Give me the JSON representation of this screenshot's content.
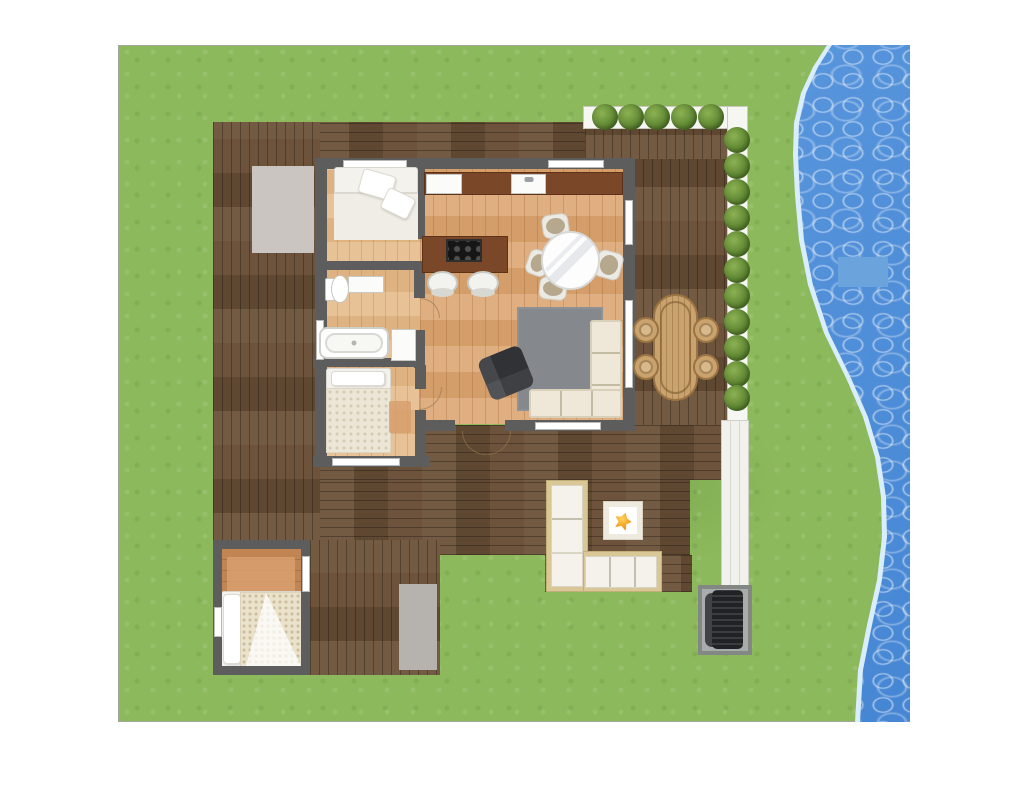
{
  "palette": {
    "grass_base": "#8cb95b",
    "water_main": "#4f93e0",
    "water_light": "#d9edfc",
    "water_patch": "#6ba3dc",
    "deck_dark": "#6a5037",
    "wood_floor": "#dca673",
    "wood_floor_light": "#e6bb8b",
    "cabin_floor": "#c08553",
    "wall": "#5d5d5d",
    "counter": "#7b4729",
    "cream": "#efe8d8",
    "rug_gray": "#85898d",
    "mat_gray": "#b6b2ad",
    "mat_warm": "#cac5c0",
    "rattan": "#c9a26e",
    "rattan_dark": "#9a7442",
    "tan_rug": "#d89f6e"
  },
  "scene": {
    "description": "top-down floor plan of a small house with wrap deck, top-right hedge patio, outdoor lounge with fire pit, detached cabin room, lawn and waterfront on the right",
    "items": [
      {
        "name": "lawn",
        "cls": "grass",
        "x": 118,
        "y": 45,
        "w": 792,
        "h": 677
      },
      {
        "name": "water-shoreline",
        "cls": "water-edge",
        "x": 118,
        "y": 45,
        "w": 792,
        "h": 677
      },
      {
        "name": "water-body",
        "cls": "water",
        "x": 118,
        "y": 45,
        "w": 792,
        "h": 677
      },
      {
        "name": "water-float-patch",
        "cls": "water-patch",
        "x": 838,
        "y": 257,
        "w": 50,
        "h": 30
      },
      {
        "name": "deck-top-strip",
        "cls": "deck-h",
        "x": 213,
        "y": 122,
        "w": 377,
        "h": 47
      },
      {
        "name": "deck-left-column",
        "cls": "deck-v",
        "x": 213,
        "y": 122,
        "w": 107,
        "h": 425
      },
      {
        "name": "patio-upper-deck",
        "cls": "deck-v",
        "x": 585,
        "y": 128,
        "w": 145,
        "h": 41
      },
      {
        "name": "patio-right-deck",
        "cls": "deck-v",
        "x": 634,
        "y": 159,
        "w": 96,
        "h": 266
      },
      {
        "name": "deck-bottom-wide",
        "cls": "deck-h",
        "x": 320,
        "y": 425,
        "w": 402,
        "h": 55
      },
      {
        "name": "deck-bottom-main",
        "cls": "deck-h",
        "x": 320,
        "y": 480,
        "w": 370,
        "h": 75
      },
      {
        "name": "deck-bottom-left-column",
        "cls": "deck-v",
        "x": 310,
        "y": 540,
        "w": 130,
        "h": 135
      },
      {
        "name": "deck-lounge-extension",
        "cls": "deck-h",
        "x": 545,
        "y": 555,
        "w": 147,
        "h": 37
      },
      {
        "name": "planter-top",
        "cls": "planter",
        "x": 583,
        "y": 106,
        "w": 165,
        "h": 23
      },
      {
        "name": "planter-right",
        "cls": "planter",
        "x": 727,
        "y": 106,
        "w": 21,
        "h": 319
      },
      {
        "name": "walkway",
        "cls": "walkway",
        "x": 721,
        "y": 420,
        "w": 28,
        "h": 170
      },
      {
        "name": "bush-top-1",
        "cls": "bush",
        "x": 592,
        "y": 104,
        "w": 26,
        "h": 26
      },
      {
        "name": "bush-top-2",
        "cls": "bush",
        "x": 618,
        "y": 104,
        "w": 26,
        "h": 26
      },
      {
        "name": "bush-top-3",
        "cls": "bush",
        "x": 644,
        "y": 104,
        "w": 26,
        "h": 26
      },
      {
        "name": "bush-top-4",
        "cls": "bush",
        "x": 671,
        "y": 104,
        "w": 26,
        "h": 26
      },
      {
        "name": "bush-top-5",
        "cls": "bush",
        "x": 698,
        "y": 104,
        "w": 26,
        "h": 26
      },
      {
        "name": "bush-right-1",
        "cls": "bush",
        "x": 724,
        "y": 127,
        "w": 26,
        "h": 26
      },
      {
        "name": "bush-right-2",
        "cls": "bush",
        "x": 724,
        "y": 153,
        "w": 26,
        "h": 26
      },
      {
        "name": "bush-right-3",
        "cls": "bush",
        "x": 724,
        "y": 179,
        "w": 26,
        "h": 26
      },
      {
        "name": "bush-right-4",
        "cls": "bush",
        "x": 724,
        "y": 205,
        "w": 26,
        "h": 26
      },
      {
        "name": "bush-right-5",
        "cls": "bush",
        "x": 724,
        "y": 231,
        "w": 26,
        "h": 26
      },
      {
        "name": "bush-right-6",
        "cls": "bush",
        "x": 724,
        "y": 257,
        "w": 26,
        "h": 26
      },
      {
        "name": "bush-right-7",
        "cls": "bush",
        "x": 724,
        "y": 283,
        "w": 26,
        "h": 26
      },
      {
        "name": "bush-right-8",
        "cls": "bush",
        "x": 724,
        "y": 309,
        "w": 26,
        "h": 26
      },
      {
        "name": "bush-right-9",
        "cls": "bush",
        "x": 724,
        "y": 335,
        "w": 26,
        "h": 26
      },
      {
        "name": "bush-right-10",
        "cls": "bush",
        "x": 724,
        "y": 361,
        "w": 26,
        "h": 26
      },
      {
        "name": "bush-right-11",
        "cls": "bush",
        "x": 724,
        "y": 385,
        "w": 26,
        "h": 26
      },
      {
        "name": "entry-mat",
        "cls": "mat-warm",
        "x": 252,
        "y": 166,
        "w": 62,
        "h": 87
      },
      {
        "name": "deck-mat",
        "cls": "mat-gray",
        "x": 399,
        "y": 584,
        "w": 38,
        "h": 86
      },
      {
        "name": "cabin-floor",
        "cls": "floor-cabin",
        "x": 218,
        "y": 547,
        "w": 87,
        "h": 123
      },
      {
        "name": "cabin-rug",
        "cls": "rug-tan",
        "x": 227,
        "y": 557,
        "w": 68,
        "h": 42
      },
      {
        "name": "cabin-bed",
        "cls": "bed-base",
        "x": 221,
        "y": 591,
        "w": 82,
        "h": 77
      },
      {
        "name": "cabin-bed-pillow",
        "cls": "pillow",
        "x": 223,
        "y": 594,
        "w": 18,
        "h": 70
      },
      {
        "name": "cabin-bed-blanket",
        "cls": "blanket",
        "x": 240,
        "y": 592,
        "w": 62,
        "h": 75
      },
      {
        "name": "cabin-wall-top",
        "cls": "wall",
        "x": 213,
        "y": 540,
        "w": 97,
        "h": 9
      },
      {
        "name": "cabin-wall-left",
        "cls": "wall",
        "x": 213,
        "y": 540,
        "w": 9,
        "h": 135
      },
      {
        "name": "cabin-wall-right",
        "cls": "wall",
        "x": 301,
        "y": 540,
        "w": 9,
        "h": 135
      },
      {
        "name": "cabin-wall-bottom",
        "cls": "wall",
        "x": 213,
        "y": 666,
        "w": 97,
        "h": 9
      },
      {
        "name": "cabin-window-right",
        "cls": "window",
        "x": 302,
        "y": 556,
        "w": 8,
        "h": 36
      },
      {
        "name": "cabin-window-left",
        "cls": "window",
        "x": 214,
        "y": 607,
        "w": 8,
        "h": 30
      },
      {
        "name": "floor-kitchen-living",
        "cls": "floor-wood",
        "x": 420,
        "y": 166,
        "w": 206,
        "h": 258
      },
      {
        "name": "floor-bedroom-1",
        "cls": "floor-wood-light",
        "x": 325,
        "y": 166,
        "w": 95,
        "h": 100
      },
      {
        "name": "floor-bathroom",
        "cls": "floor-wood-light",
        "x": 325,
        "y": 266,
        "w": 95,
        "h": 98
      },
      {
        "name": "floor-bedroom-2",
        "cls": "floor-wood-light",
        "x": 323,
        "y": 365,
        "w": 96,
        "h": 93
      },
      {
        "name": "living-rug",
        "cls": "rug-gray",
        "x": 517,
        "y": 307,
        "w": 86,
        "h": 104
      },
      {
        "name": "wall-top",
        "cls": "wall",
        "x": 315,
        "y": 158,
        "w": 320,
        "h": 11
      },
      {
        "name": "wall-left",
        "cls": "wall",
        "x": 315,
        "y": 158,
        "w": 12,
        "h": 309
      },
      {
        "name": "wall-right",
        "cls": "wall",
        "x": 623,
        "y": 158,
        "w": 12,
        "h": 273
      },
      {
        "name": "wall-bottom-west",
        "cls": "wall",
        "x": 420,
        "y": 420,
        "w": 35,
        "h": 11
      },
      {
        "name": "wall-bottom-east",
        "cls": "wall",
        "x": 505,
        "y": 420,
        "w": 130,
        "h": 11
      },
      {
        "name": "wall-bedroom2-bottom",
        "cls": "wall",
        "x": 313,
        "y": 456,
        "w": 117,
        "h": 11
      },
      {
        "name": "wall-bedroom1-kitchen",
        "cls": "wall",
        "x": 414,
        "y": 158,
        "w": 11,
        "h": 81
      },
      {
        "name": "wall-bedroom1-bath",
        "cls": "wall",
        "x": 325,
        "y": 261,
        "w": 90,
        "h": 9
      },
      {
        "name": "wall-bath-kitchen-upper",
        "cls": "wall",
        "x": 414,
        "y": 261,
        "w": 11,
        "h": 37
      },
      {
        "name": "wall-bath-kitchen-lower",
        "cls": "wall",
        "x": 414,
        "y": 330,
        "w": 11,
        "h": 38
      },
      {
        "name": "wall-bath-bedroom2",
        "cls": "wall",
        "x": 313,
        "y": 358,
        "w": 112,
        "h": 9
      },
      {
        "name": "wall-bedroom2-right-upper",
        "cls": "wall",
        "x": 415,
        "y": 365,
        "w": 11,
        "h": 24
      },
      {
        "name": "wall-bedroom2-right-lower",
        "cls": "wall",
        "x": 415,
        "y": 410,
        "w": 11,
        "h": 52
      },
      {
        "name": "window-bedroom1-top",
        "cls": "window",
        "x": 343,
        "y": 160,
        "w": 64,
        "h": 8
      },
      {
        "name": "window-kitchen-top",
        "cls": "window",
        "x": 548,
        "y": 160,
        "w": 56,
        "h": 8
      },
      {
        "name": "window-right-upper",
        "cls": "window",
        "x": 625,
        "y": 200,
        "w": 8,
        "h": 45
      },
      {
        "name": "window-right-lower",
        "cls": "window",
        "x": 625,
        "y": 300,
        "w": 8,
        "h": 88
      },
      {
        "name": "window-living-bottom",
        "cls": "window",
        "x": 535,
        "y": 422,
        "w": 66,
        "h": 8
      },
      {
        "name": "window-bedroom2-bottom",
        "cls": "window",
        "x": 332,
        "y": 458,
        "w": 68,
        "h": 8
      },
      {
        "name": "window-bath-left",
        "cls": "window",
        "x": 316,
        "y": 320,
        "w": 8,
        "h": 40
      },
      {
        "name": "kitchen-counter",
        "cls": "counter",
        "x": 424,
        "y": 172,
        "w": 199,
        "h": 23
      },
      {
        "name": "fridge",
        "cls": "appliance-white",
        "x": 426,
        "y": 174,
        "w": 36,
        "h": 20
      },
      {
        "name": "kitchen-sink",
        "cls": "sink",
        "x": 511,
        "y": 174,
        "w": 35,
        "h": 20
      },
      {
        "name": "kitchen-island",
        "cls": "counter",
        "x": 422,
        "y": 236,
        "w": 86,
        "h": 37
      },
      {
        "name": "cooktop",
        "cls": "cooktop",
        "x": 446,
        "y": 239,
        "w": 36,
        "h": 23
      },
      {
        "name": "bar-stool-1",
        "cls": "stool",
        "x": 427,
        "y": 271,
        "w": 31,
        "h": 24
      },
      {
        "name": "bar-stool-2",
        "cls": "stool",
        "x": 467,
        "y": 271,
        "w": 32,
        "h": 24
      },
      {
        "name": "dining-chair-top",
        "cls": "chair-pad",
        "x": 542,
        "y": 214,
        "w": 27,
        "h": 24,
        "rot": -8
      },
      {
        "name": "dining-chair-left",
        "cls": "chair-pad",
        "x": 527,
        "y": 250,
        "w": 22,
        "h": 26,
        "rot": 20
      },
      {
        "name": "dining-chair-right",
        "cls": "chair-pad",
        "x": 596,
        "y": 251,
        "w": 26,
        "h": 28,
        "rot": 15
      },
      {
        "name": "dining-chair-bottom",
        "cls": "chair-pad",
        "x": 539,
        "y": 277,
        "w": 28,
        "h": 23,
        "rot": 6
      },
      {
        "name": "dining-table",
        "cls": "table-round",
        "x": 541,
        "y": 231,
        "w": 59,
        "h": 59
      },
      {
        "name": "sofa-vertical",
        "cls": "sofa sofa-v",
        "x": 590,
        "y": 320,
        "w": 32,
        "h": 98
      },
      {
        "name": "sofa-horizontal",
        "cls": "sofa sofa-h",
        "x": 529,
        "y": 389,
        "w": 93,
        "h": 29
      },
      {
        "name": "armchair",
        "cls": "armchair",
        "x": 483,
        "y": 351,
        "w": 46,
        "h": 44,
        "rot": -22
      },
      {
        "name": "bed1",
        "cls": "bed-base",
        "x": 334,
        "y": 167,
        "w": 84,
        "h": 73
      },
      {
        "name": "bed1-duvet",
        "cls": "duvet-plain",
        "x": 334,
        "y": 192,
        "w": 84,
        "h": 48
      },
      {
        "name": "bed1-pillow-1",
        "cls": "pillow",
        "x": 360,
        "y": 172,
        "w": 34,
        "h": 25,
        "rot": 16
      },
      {
        "name": "bed1-pillow-2",
        "cls": "pillow",
        "x": 383,
        "y": 192,
        "w": 30,
        "h": 23,
        "rot": 26
      },
      {
        "name": "toilet",
        "cls": "toilet",
        "x": 325,
        "y": 273,
        "w": 24,
        "h": 30
      },
      {
        "name": "bath-vanity",
        "cls": "appliance-white",
        "x": 348,
        "y": 276,
        "w": 36,
        "h": 17
      },
      {
        "name": "bathtub",
        "cls": "tub",
        "x": 319,
        "y": 327,
        "w": 70,
        "h": 32
      },
      {
        "name": "bath-cabinet",
        "cls": "appliance-white",
        "x": 391,
        "y": 329,
        "w": 25,
        "h": 32
      },
      {
        "name": "bed2",
        "cls": "bed-base",
        "x": 326,
        "y": 368,
        "w": 65,
        "h": 85
      },
      {
        "name": "bed2-pillow",
        "cls": "pillow",
        "x": 331,
        "y": 371,
        "w": 54,
        "h": 15
      },
      {
        "name": "bed2-duvet",
        "cls": "duvet-tex",
        "x": 326,
        "y": 388,
        "w": 65,
        "h": 65
      },
      {
        "name": "bed2-rug",
        "cls": "rug-tan",
        "x": 389,
        "y": 401,
        "w": 22,
        "h": 32
      },
      {
        "name": "outdoor-sofa-base-vertical",
        "cls": "osofa-base",
        "x": 546,
        "y": 480,
        "w": 42,
        "h": 112
      },
      {
        "name": "outdoor-sofa-base-horizontal",
        "cls": "osofa-base",
        "x": 583,
        "y": 551,
        "w": 79,
        "h": 41
      },
      {
        "name": "outdoor-sofa-cushions-vertical",
        "cls": "osofa-cush",
        "x": 551,
        "y": 485,
        "w": 32,
        "h": 68
      },
      {
        "name": "outdoor-sofa-cushion-corner",
        "cls": "osofa-cush",
        "x": 551,
        "y": 553,
        "w": 32,
        "h": 34
      },
      {
        "name": "outdoor-sofa-cushions-horizontal",
        "cls": "osofa-cush-h",
        "x": 585,
        "y": 556,
        "w": 72,
        "h": 32
      },
      {
        "name": "fire-pit",
        "cls": "firepit",
        "x": 604,
        "y": 502,
        "w": 38,
        "h": 37
      },
      {
        "name": "wicker-table",
        "cls": "wicker-table",
        "x": 653,
        "y": 294,
        "w": 45,
        "h": 107
      },
      {
        "name": "wicker-chair-1",
        "cls": "wicker-chair",
        "x": 633,
        "y": 317,
        "w": 26,
        "h": 26
      },
      {
        "name": "wicker-chair-2",
        "cls": "wicker-chair",
        "x": 633,
        "y": 354,
        "w": 26,
        "h": 26
      },
      {
        "name": "wicker-chair-3",
        "cls": "wicker-chair",
        "x": 693,
        "y": 317,
        "w": 26,
        "h": 26
      },
      {
        "name": "wicker-chair-4",
        "cls": "wicker-chair",
        "x": 693,
        "y": 354,
        "w": 26,
        "h": 26
      },
      {
        "name": "grill-mat",
        "cls": "grill-mat",
        "x": 698,
        "y": 585,
        "w": 54,
        "h": 70
      },
      {
        "name": "grill-shelf",
        "cls": "grill-shelf",
        "x": 705,
        "y": 593,
        "w": 14,
        "h": 54
      },
      {
        "name": "grill-body",
        "cls": "grill-body",
        "x": 712,
        "y": 590,
        "w": 31,
        "h": 59
      },
      {
        "name": "door-arc-bedroom2",
        "cls": "arc arc-br",
        "x": 419,
        "y": 387,
        "w": 23,
        "h": 23
      },
      {
        "name": "door-arc-bathroom",
        "cls": "arc arc-tr",
        "x": 420,
        "y": 298,
        "w": 20,
        "h": 20
      },
      {
        "name": "door-arc-deck-1",
        "cls": "arc arc-bl",
        "x": 462,
        "y": 431,
        "w": 24,
        "h": 24
      },
      {
        "name": "door-arc-deck-2",
        "cls": "arc arc-br",
        "x": 487,
        "y": 431,
        "w": 24,
        "h": 24
      }
    ]
  }
}
